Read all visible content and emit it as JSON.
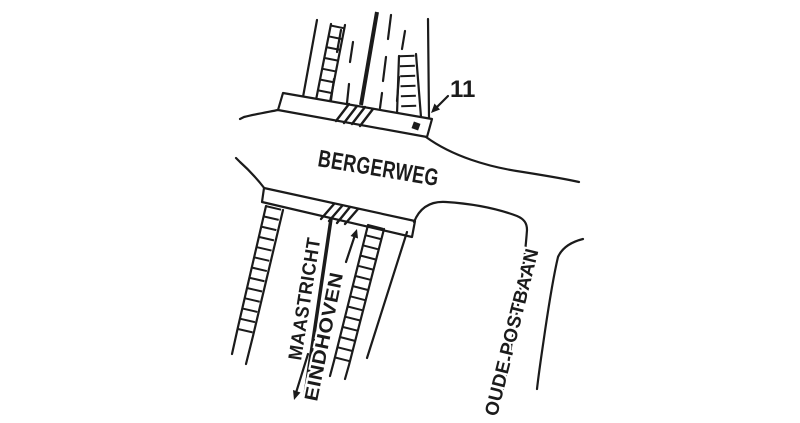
{
  "sketch": {
    "background_color": "#ffffff",
    "ink_color": "#1b1b1b",
    "roads": {
      "main_road_label": "BERGERWEG",
      "south_road_destination_left": "MAASTRICHT",
      "south_road_destination_right": "EINDHOVEN",
      "side_road_label": "OUDE POSTBAAN"
    },
    "marker": {
      "label": "11"
    }
  }
}
